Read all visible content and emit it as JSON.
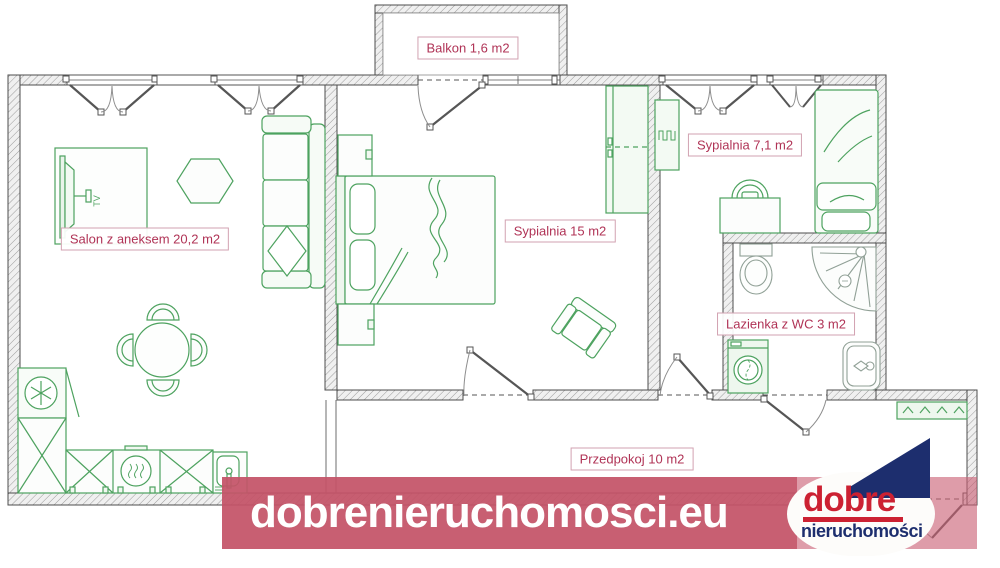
{
  "plan": {
    "title": "Apartment floor plan",
    "rooms": [
      {
        "id": "balkon",
        "name": "Balkon",
        "area": "1,6 m2",
        "label": "Balkon 1,6 m2"
      },
      {
        "id": "salon",
        "name": "Salon z aneksem",
        "area": "20,2 m2",
        "label": "Salon z aneksem 20,2 m2"
      },
      {
        "id": "sypialnia-15",
        "name": "Sypialnia",
        "area": "15 m2",
        "label": "Sypialnia 15 m2"
      },
      {
        "id": "sypialnia-71",
        "name": "Sypialnia",
        "area": "7,1 m2",
        "label": "Sypialnia 7,1 m2"
      },
      {
        "id": "lazienka",
        "name": "Lazienka z WC",
        "area": "3 m2",
        "label": "Lazienka z WC 3 m2"
      },
      {
        "id": "przedpokoj",
        "name": "Przedpokoj",
        "area": "10 m2",
        "label": "Przedpokoj 10 m2"
      }
    ]
  },
  "watermark": {
    "url_text": "dobrenieruchomosci.eu"
  },
  "logo": {
    "line1": "dobre",
    "line2": "nieruchomości"
  },
  "icons": {
    "tv_label": "TV",
    "furniture_icons": [
      "tv-icon",
      "hex-table-icon",
      "sofa-icon",
      "dining-table-icon",
      "fridge-icon",
      "kitchen-cabinet-icon",
      "stove-icon",
      "kitchen-sink-icon",
      "double-bed-icon",
      "nightstand-icon",
      "wardrobe-icon",
      "armchair-icon",
      "radiator-icon",
      "single-bed-icon",
      "desk-chair-icon",
      "toilet-icon",
      "shower-icon",
      "washing-machine-icon",
      "bathroom-sink-icon",
      "shoe-cabinet-icon",
      "entrance-door-icon"
    ]
  },
  "colors": {
    "banner_red": "#c45367",
    "label_text": "#b03356",
    "label_border": "#d2a2b1",
    "furniture_green": "#4da25f",
    "fixture_gray": "#90a096",
    "wall_outline": "#4c4c4c",
    "logo_red": "#cc2132",
    "logo_navy": "#1d2e6e"
  }
}
